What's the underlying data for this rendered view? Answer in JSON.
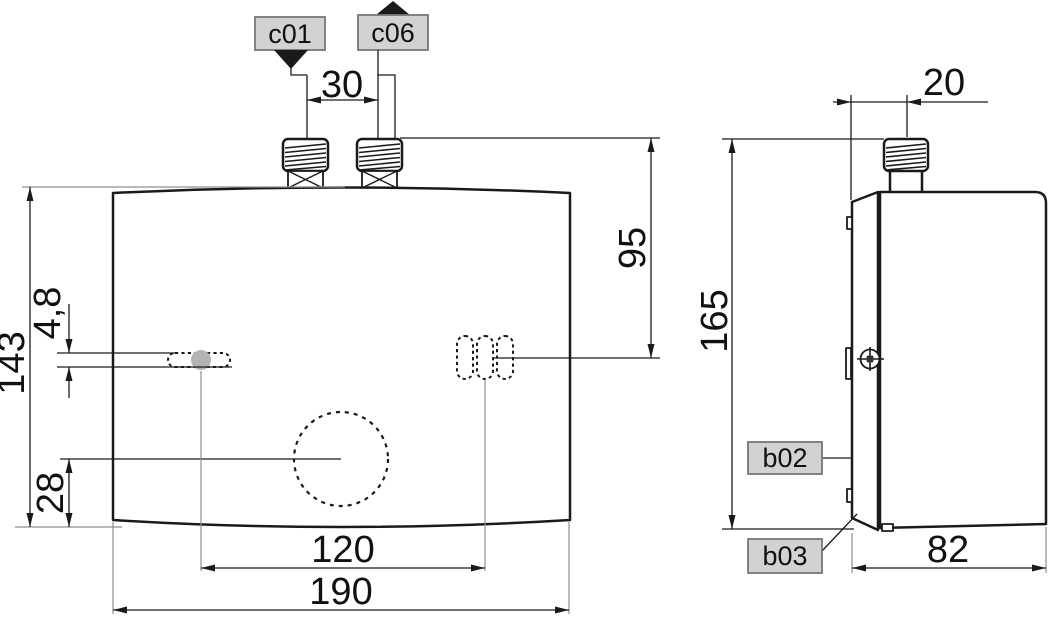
{
  "figure": {
    "type": "technical-dimension-drawing",
    "callouts": {
      "c01": "c01",
      "c06": "c06",
      "b02": "b02",
      "b03": "b03"
    },
    "dimensions": {
      "pipe_spacing": "30",
      "body_height": "143",
      "keyhole_slot_height": "4,8",
      "knob_offset": "28",
      "mounting_spacing": "120",
      "body_width": "190",
      "pipe_top_to_slot": "95",
      "overall_height": "165",
      "wall_to_pipe_center": "20",
      "body_depth": "82"
    },
    "colors": {
      "background": "#ffffff",
      "outline": "#1a1a1a",
      "extension_line": "#8f8f8f",
      "callout_fill": "#d2d2d2",
      "callout_border": "#777777",
      "marker_fill": "#b3b3b3"
    }
  }
}
